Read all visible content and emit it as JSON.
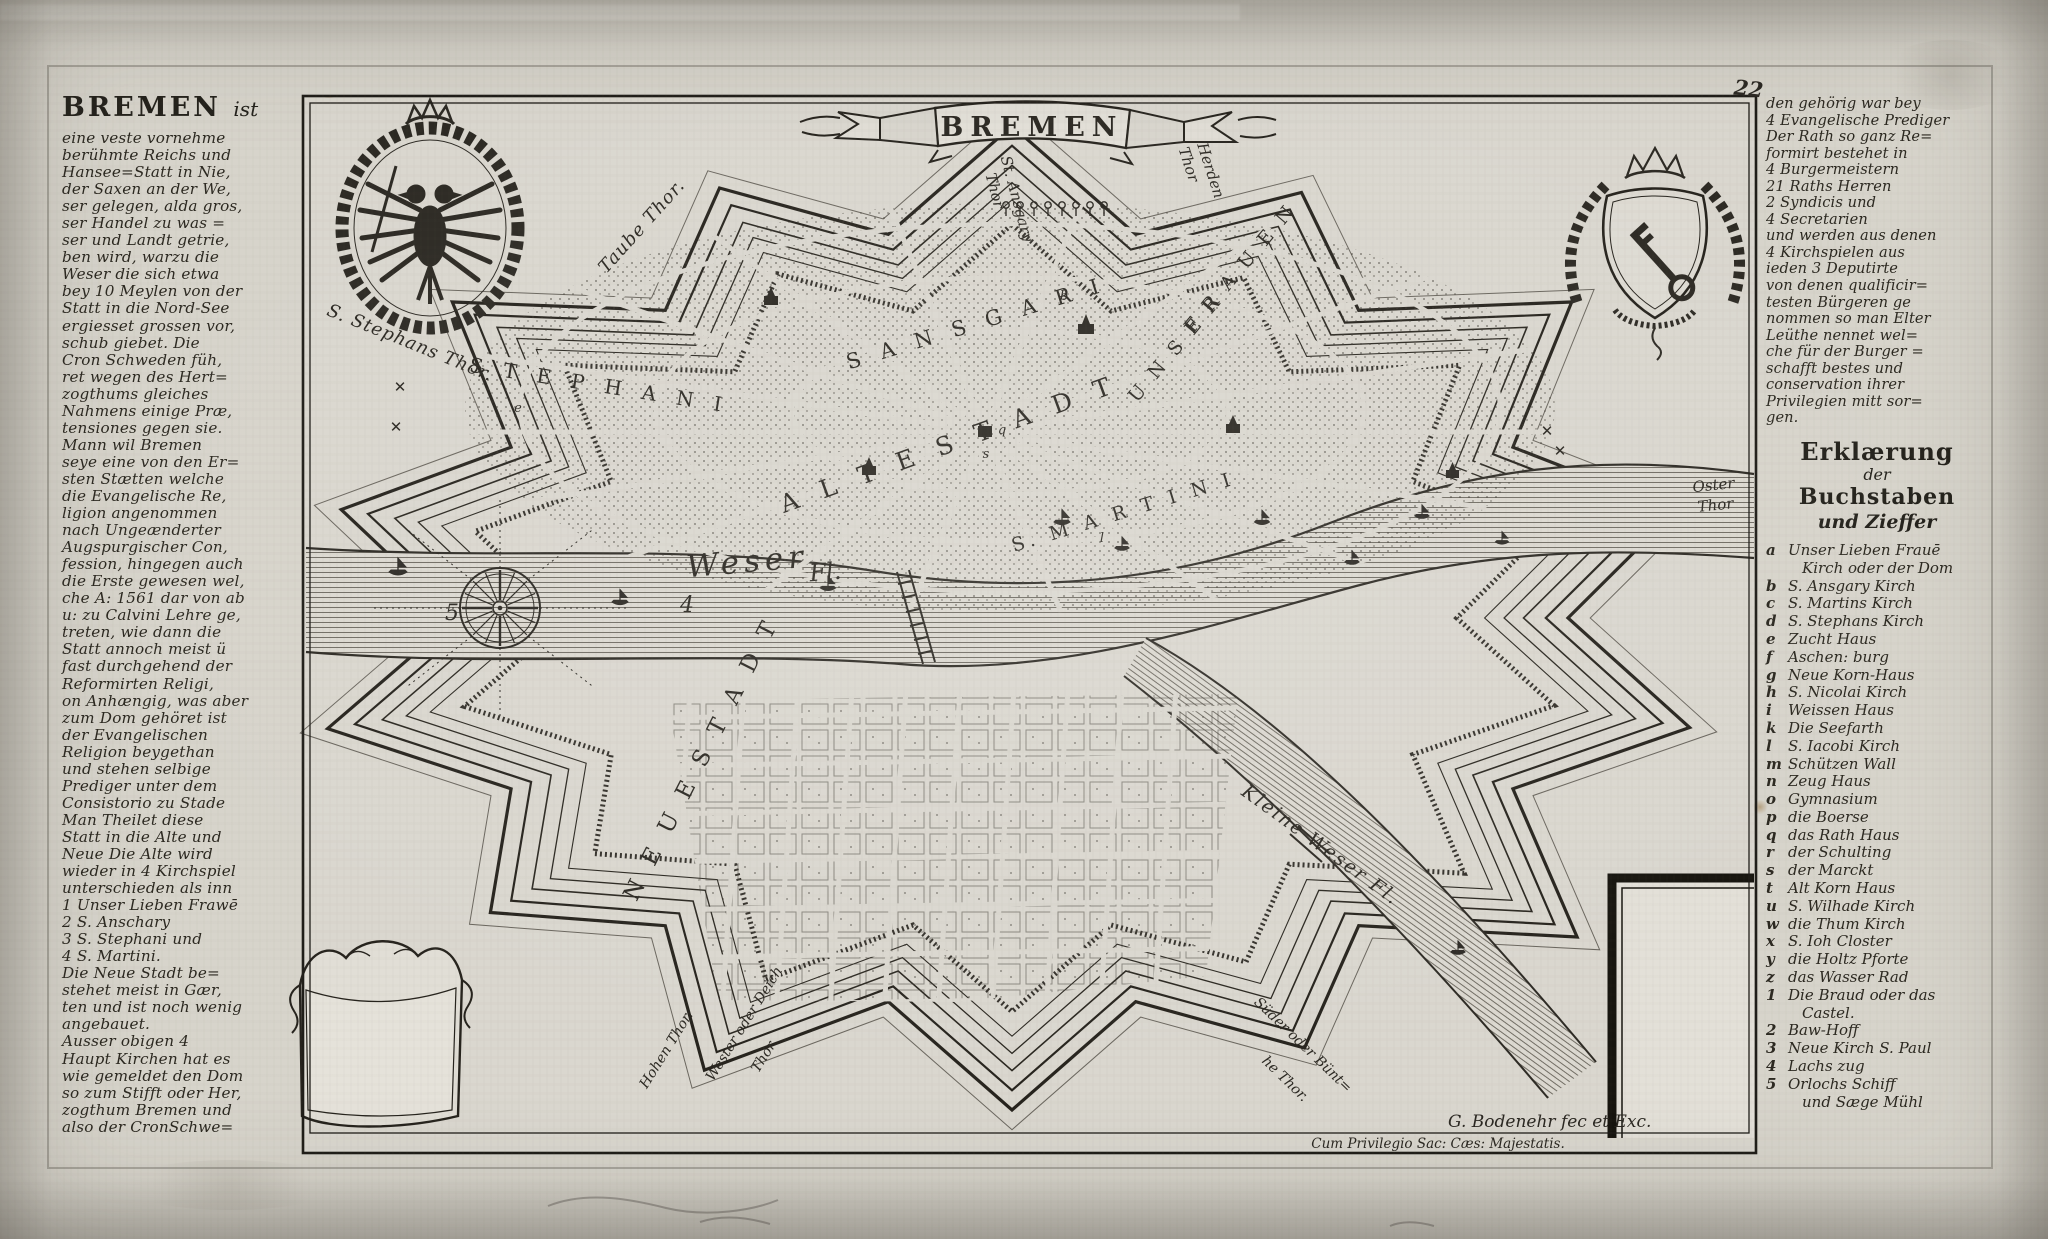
{
  "page": {
    "number": "22"
  },
  "left_column": {
    "heading": "BREMEN",
    "heading_suffix": "ist",
    "lines": [
      "eine veste vornehme",
      "berühmte Reichs und",
      "Hansee=Statt in Nie,",
      "der Saxen an der We,",
      "ser gelegen, alda gros,",
      "ser Handel zu was =",
      "ser und Landt getrie,",
      "ben wird, warzu die",
      "Weser die sich etwa",
      "bey 10 Meylen von der",
      "Statt in die Nord-See",
      "ergiesset grossen vor,",
      "schub giebet.  Die",
      "Cron Schweden füh,",
      "ret wegen des Hert=",
      "zogthums gleiches",
      "Nahmens einige Præ,",
      "tensiones gegen sie.",
      "Mann wil Bremen",
      "seye eine von den Er=",
      "sten Stætten welche",
      "die Evangelische Re,",
      "ligion angenommen",
      "nach Ungeænderter",
      "Augspurgischer Con,",
      "fession, hingegen auch",
      "die Erste gewesen wel,",
      "che A: 1561 dar von ab",
      "u: zu Calvini Lehre ge,",
      "treten, wie dann die",
      "Statt annoch meist ü",
      "fast durchgehend der",
      "Reformirten Religi,",
      "on Anhængig, was aber",
      "zum Dom gehöret ist",
      "der Evangelischen",
      "Religion beygethan",
      "und stehen selbige",
      "Prediger unter dem",
      "Consistorio zu Stade",
      "Man Theilet diese",
      "Statt in die Alte und",
      "Neue Die Alte wird",
      "wieder in 4 Kirchspiel",
      "unterschieden als inn",
      "1 Unser Lieben Frawē",
      "2 S. Anschary",
      "3 S. Stephani und",
      "4 S. Martini.",
      "Die Neue Stadt be=",
      "stehet meist in Gær,",
      "ten und ist noch wenig",
      "angebauet.",
      "Ausser obigen 4",
      "Haupt Kirchen hat es",
      "wie gemeldet den Dom",
      "so zum Stifft oder Her,",
      "zogthum Bremen und",
      "also der CronSchwe="
    ]
  },
  "right_column": {
    "intro_lines": [
      "den gehörig war bey",
      "4 Evangelische Prediger",
      "Der Rath so ganz Re=",
      "formirt bestehet in",
      "4 Burgermeistern",
      "21 Raths Herren",
      "2 Syndicis und",
      "4 Secretarien",
      "und werden aus denen",
      "4 Kirchspielen aus",
      "ieden 3 Deputirte",
      "von denen qualificir=",
      "testen Bürgeren ge",
      "nommen so man Elter",
      "Leüthe nennet wel=",
      "che für der Burger =",
      "schafft bestes und",
      "conservation ihrer",
      "Privilegien mitt sor=",
      "gen."
    ],
    "legend_title_lines": [
      "Erklærung",
      "der",
      "Buchstaben",
      "und Zieffer"
    ],
    "legend": [
      {
        "k": "a",
        "t": "Unser Lieben Frauē"
      },
      {
        "k": "",
        "t": "Kirch oder der Dom"
      },
      {
        "k": "b",
        "t": "S. Ansgary Kirch"
      },
      {
        "k": "c",
        "t": "S. Martins Kirch"
      },
      {
        "k": "d",
        "t": "S. Stephans Kirch"
      },
      {
        "k": "e",
        "t": "Zucht Haus"
      },
      {
        "k": "f",
        "t": "Aschen: burg"
      },
      {
        "k": "g",
        "t": "Neue Korn-Haus"
      },
      {
        "k": "h",
        "t": "S. Nicolai Kirch"
      },
      {
        "k": "i",
        "t": "Weissen Haus"
      },
      {
        "k": "k",
        "t": "Die Seefarth"
      },
      {
        "k": "l",
        "t": "S. Iacobi Kirch"
      },
      {
        "k": "m",
        "t": "Schützen Wall"
      },
      {
        "k": "n",
        "t": "Zeug Haus"
      },
      {
        "k": "o",
        "t": "Gymnasium"
      },
      {
        "k": "p",
        "t": "die Boerse"
      },
      {
        "k": "q",
        "t": "das Rath Haus"
      },
      {
        "k": "r",
        "t": "der Schulting"
      },
      {
        "k": "s",
        "t": "der Marckt"
      },
      {
        "k": "t",
        "t": "Alt Korn Haus"
      },
      {
        "k": "u",
        "t": "S. Wilhade Kirch"
      },
      {
        "k": "w",
        "t": "die Thum Kirch"
      },
      {
        "k": "x",
        "t": "S. Ioh Closter"
      },
      {
        "k": "y",
        "t": "die Holtz Pforte"
      },
      {
        "k": "z",
        "t": "das Wasser Rad"
      },
      {
        "k": "1",
        "t": "Die Braud oder das"
      },
      {
        "k": "",
        "t": "Castel."
      },
      {
        "k": "2",
        "t": "Baw-Hoff"
      },
      {
        "k": "3",
        "t": "Neue Kirch S. Paul"
      },
      {
        "k": "4",
        "t": "Lachs zug"
      },
      {
        "k": "5",
        "t": "Orlochs Schiff"
      },
      {
        "k": "",
        "t": "und Sæge Mühl"
      }
    ]
  },
  "map": {
    "banner": "BREMEN",
    "signature": "G. Bodenehr fec et Exc.",
    "privilege": "Cum Privilegio Sac: Cæs: Majestatis.",
    "ink_color": "#2b2822",
    "paper_color": "#d7d4cb",
    "labels": [
      {
        "text": "Taube Thor.",
        "x": 646,
        "y": 230,
        "r": -48,
        "s": 18,
        "sp": 1,
        "i": 1
      },
      {
        "text": "St. Ansgary",
        "x": 1012,
        "y": 200,
        "r": 75,
        "s": 15,
        "i": 1
      },
      {
        "text": "Thor",
        "x": 990,
        "y": 192,
        "r": 75,
        "s": 15,
        "i": 1
      },
      {
        "text": "Herden",
        "x": 1206,
        "y": 172,
        "r": 72,
        "s": 15,
        "i": 1
      },
      {
        "text": "Thor",
        "x": 1184,
        "y": 166,
        "r": 72,
        "s": 15,
        "i": 1
      },
      {
        "text": "S. Stephans Thor.",
        "x": 408,
        "y": 348,
        "r": 22,
        "s": 18,
        "sp": 1,
        "i": 1
      },
      {
        "text": "Oster",
        "x": 1714,
        "y": 490,
        "r": -6,
        "s": 15,
        "i": 1
      },
      {
        "text": "Thor",
        "x": 1716,
        "y": 510,
        "r": -6,
        "s": 15,
        "i": 1
      },
      {
        "text": "Weser",
        "x": 748,
        "y": 572,
        "r": -5,
        "s": 31,
        "sp": 5,
        "i": 1
      },
      {
        "text": "Fl.",
        "x": 826,
        "y": 580,
        "r": -5,
        "s": 24,
        "i": 1
      },
      {
        "text": "Kleine Weser Fl.",
        "x": 1317,
        "y": 850,
        "r": 36,
        "s": 19,
        "sp": 2,
        "i": 1
      },
      {
        "text": "S T E P H A N I",
        "x": 598,
        "y": 392,
        "r": 9,
        "s": 20,
        "sp": 7
      },
      {
        "text": "S A N S G A R I",
        "x": 978,
        "y": 330,
        "r": -17,
        "s": 21,
        "sp": 7
      },
      {
        "text": "A L T E  S T A D T",
        "x": 952,
        "y": 452,
        "r": -20,
        "s": 25,
        "sp": 8
      },
      {
        "text": "U N S E R",
        "x": 1180,
        "y": 352,
        "r": -50,
        "s": 19,
        "sp": 4
      },
      {
        "text": "F R A U E N",
        "x": 1245,
        "y": 272,
        "r": -50,
        "s": 19,
        "sp": 4
      },
      {
        "text": "S. M A R T I N I",
        "x": 1125,
        "y": 518,
        "r": -17,
        "s": 19,
        "sp": 5
      },
      {
        "text": "N E U E S T A D T",
        "x": 708,
        "y": 762,
        "r": -63,
        "s": 23,
        "sp": 6
      },
      {
        "text": "5",
        "x": 452,
        "y": 620,
        "r": 0,
        "s": 22,
        "i": 1
      },
      {
        "text": "4",
        "x": 687,
        "y": 612,
        "r": 0,
        "s": 22,
        "i": 1
      },
      {
        "text": "Hohen Thor.",
        "x": 670,
        "y": 1052,
        "r": -58,
        "s": 14,
        "i": 1
      },
      {
        "text": "Wester oder Deich",
        "x": 748,
        "y": 1026,
        "r": -58,
        "s": 14,
        "i": 1
      },
      {
        "text": "Thor.",
        "x": 768,
        "y": 1058,
        "r": -58,
        "s": 14,
        "i": 1
      },
      {
        "text": "Süder oder Bünt=",
        "x": 1300,
        "y": 1048,
        "r": 44,
        "s": 14,
        "i": 1
      },
      {
        "text": "he Thor.",
        "x": 1282,
        "y": 1082,
        "r": 44,
        "s": 14,
        "i": 1
      },
      {
        "text": "q",
        "x": 1002,
        "y": 434,
        "r": 0,
        "s": 13,
        "i": 1
      },
      {
        "text": "s",
        "x": 986,
        "y": 458,
        "r": 0,
        "s": 13,
        "i": 1
      },
      {
        "text": "b",
        "x": 1064,
        "y": 300,
        "r": 0,
        "s": 13,
        "i": 1
      },
      {
        "text": "l",
        "x": 1102,
        "y": 542,
        "r": 0,
        "s": 13,
        "i": 1
      },
      {
        "text": "e",
        "x": 518,
        "y": 412,
        "r": 0,
        "s": 13,
        "i": 1
      },
      {
        "text": "✕",
        "x": 400,
        "y": 392,
        "r": 0,
        "s": 15
      },
      {
        "text": "✕",
        "x": 396,
        "y": 432,
        "r": 0,
        "s": 15
      },
      {
        "text": "✕",
        "x": 1547,
        "y": 436,
        "r": 0,
        "s": 15
      },
      {
        "text": "✕",
        "x": 1560,
        "y": 456,
        "r": 0,
        "s": 15
      }
    ]
  }
}
